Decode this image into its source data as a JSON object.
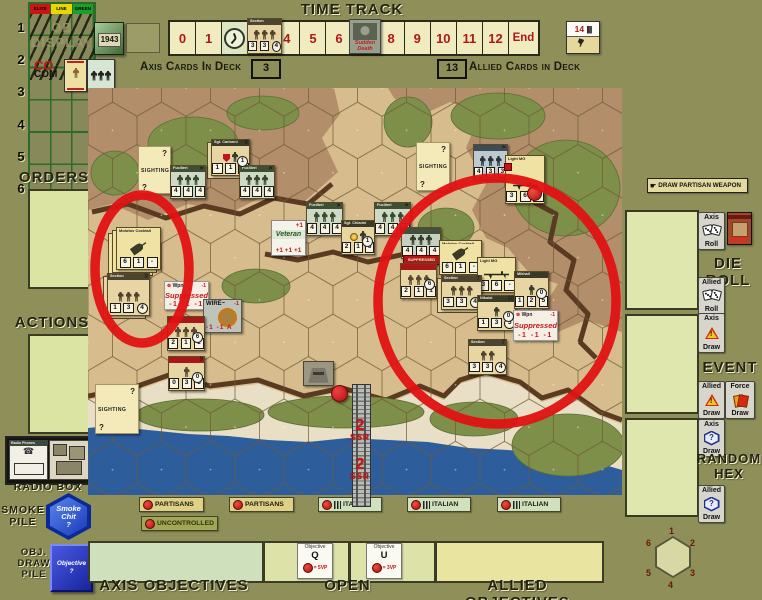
{
  "colors": {
    "accent_red": "#e01212",
    "sea": "#2e5d9c",
    "sand": "#d7bd8d",
    "hill": "#b28e6a",
    "scrub": "#7e8f4a",
    "counter_tan": "#e7d5a4",
    "counter_green": "#cfdac4"
  },
  "ob_display": {
    "headers": [
      "ELITE",
      "LINE",
      "GREEN"
    ],
    "rows": [
      "1",
      "2",
      "3",
      "4",
      "5",
      "6"
    ],
    "ghost1": "OB",
    "ghost2": "DISPLAY",
    "co": "CO",
    "com": "COM"
  },
  "year_card": "1943",
  "time_track": {
    "title": "TIME TRACK",
    "cells": [
      "0",
      "1",
      "2",
      "3",
      "4",
      "5",
      "6",
      "7",
      "8",
      "9",
      "10",
      "11",
      "12",
      "End"
    ],
    "current_cell": "2",
    "hand_card": {
      "number": "14",
      "tallies": "||||"
    }
  },
  "decks": {
    "axis_label": "Axis Cards In Deck",
    "axis_count": "3",
    "allied_count": "13",
    "allied_label": "Allied Cards in Deck"
  },
  "left_panel": {
    "orders": "ORDERS",
    "actions": "ACTIONS",
    "radio_box": "RADIO BOX",
    "radio_card": "Radio Phones",
    "smoke_pile": [
      "SMOKE",
      "PILE"
    ],
    "smoke_chit": [
      "Smoke",
      "Chit",
      "?"
    ],
    "obj_pile": [
      "OBJ.",
      "DRAW",
      "PILE"
    ],
    "obj_chit": [
      "Objective",
      "?"
    ]
  },
  "right_panel": {
    "draw_partisan": "DRAW PARTISAN WEAPON",
    "die_roll": "DIE ROLL",
    "event": "EVENT",
    "random_hex": [
      "RANDOM",
      "HEX"
    ],
    "buttons": {
      "axis_roll": [
        "Axis",
        "Roll"
      ],
      "allied_roll": [
        "Allied",
        "Roll"
      ],
      "axis_event": [
        "Axis",
        "Draw"
      ],
      "allied_event": [
        "Allied",
        "Draw"
      ],
      "force_draw": [
        "Force",
        "Draw"
      ],
      "axis_hex": [
        "Axis",
        "Draw"
      ],
      "allied_hex": [
        "Allied",
        "Draw"
      ]
    },
    "compass": [
      "1",
      "2",
      "3",
      "4",
      "5",
      "6"
    ]
  },
  "bottom": {
    "faction_buttons": [
      {
        "label": "PARTISANS",
        "style": "partisan",
        "x": 139,
        "y": 497,
        "w": 57
      },
      {
        "label": "PARTISANS",
        "style": "partisan",
        "x": 229,
        "y": 497,
        "w": 57
      },
      {
        "label": "ITALIAN",
        "style": "italian",
        "x": 318,
        "y": 497,
        "w": 56
      },
      {
        "label": "ITALIAN",
        "style": "italian",
        "x": 407,
        "y": 497,
        "w": 56
      },
      {
        "label": "ITALIAN",
        "style": "italian",
        "x": 497,
        "y": 497,
        "w": 56
      },
      {
        "label": "UNCONTROLLED",
        "style": "uncontrolled",
        "x": 141,
        "y": 516,
        "w": 60
      }
    ],
    "zones": [
      "AXIS OBJECTIVES",
      "OPEN",
      "ALLIED OBJECTIVES"
    ],
    "objective_cards": [
      {
        "title": "Objective",
        "letter": "Q",
        "vp": "= 5VP",
        "x": 297,
        "y": 543
      },
      {
        "title": "Objective",
        "letter": "U",
        "vp": "= 3VP",
        "x": 366,
        "y": 543
      }
    ]
  },
  "map": {
    "units": [
      {
        "t": "sighting",
        "x": 138,
        "y": 146,
        "w": 31,
        "h": 46,
        "q": "?",
        "label": "SIGHTING"
      },
      {
        "t": "sighting",
        "x": 95,
        "y": 384,
        "w": 42,
        "h": 48,
        "q": "?",
        "label": "SIGHTING"
      },
      {
        "t": "sighting",
        "x": 416,
        "y": 142,
        "w": 32,
        "h": 47,
        "q": "?",
        "label": "SIGHTING"
      },
      {
        "t": "ldr",
        "name": "Sgt. Carlonni",
        "x": 211,
        "y": 139,
        "w": 37,
        "h": 35,
        "vals": [
          "1",
          "1",
          "6"
        ],
        "bg": "#e7d5a4",
        "badge": "1",
        "corner": "8",
        "stack": 2,
        "shield": true
      },
      {
        "t": "sec",
        "name": "Fucilieri",
        "x": 170,
        "y": 165,
        "w": 34,
        "h": 32,
        "vals": [
          "4",
          "4",
          "4"
        ],
        "bg": "#cfdac4",
        "band": "#3f4f36",
        "fig": "#38482e",
        "figs": 3,
        "flag": true
      },
      {
        "t": "sec",
        "name": "Fucilieri",
        "x": 239,
        "y": 165,
        "w": 34,
        "h": 32,
        "vals": [
          "4",
          "4",
          "4"
        ],
        "bg": "#cfdac4",
        "band": "#3f4f36",
        "fig": "#38482e",
        "figs": 3,
        "flag": true
      },
      {
        "t": "vet",
        "x": 271,
        "y": 220,
        "w": 33,
        "h": 34,
        "title": "Veteran",
        "tr": "+1",
        "bot": "+1 +1 +1"
      },
      {
        "t": "sec",
        "name": "Fucilieri",
        "x": 306,
        "y": 202,
        "w": 35,
        "h": 32,
        "vals": [
          "4",
          "4",
          "4"
        ],
        "bg": "#cfdac4",
        "band": "#3f4f36",
        "fig": "#38482e",
        "figs": 3,
        "flag": true
      },
      {
        "t": "ldr",
        "name": "Sgt. Chiarini",
        "x": 341,
        "y": 220,
        "w": 32,
        "h": 33,
        "vals": [
          "2",
          "1",
          "6"
        ],
        "bg": "#e7d5a4",
        "badge": "1",
        "medal": true
      },
      {
        "t": "sec",
        "name": "Fucilieri",
        "x": 374,
        "y": 202,
        "w": 35,
        "h": 32,
        "vals": [
          "4",
          "4",
          "4"
        ],
        "bg": "#cfdac4",
        "band": "#3f4f36",
        "fig": "#38482e",
        "figs": 3,
        "flag": true
      },
      {
        "t": "wpn",
        "name": "Molotov Cocktail",
        "icon": "bottle",
        "x": 116,
        "y": 227,
        "w": 43,
        "h": 41,
        "vals": [
          "6",
          "1",
          "-"
        ],
        "stack": 3,
        "bg": "#efe2a2"
      },
      {
        "t": "sec",
        "name": "Section",
        "x": 107,
        "y": 273,
        "w": 41,
        "h": 41,
        "vals": [
          "1",
          "3",
          "4"
        ],
        "circ": true,
        "bg": "#e7d5a4",
        "band": "#4a4430",
        "fig": "#51402a",
        "figs": 3,
        "corner": "9",
        "stack": 2
      },
      {
        "t": "sup",
        "x": 164,
        "y": 281,
        "w": 43,
        "h": 27,
        "wpn": "Wpn",
        "m1": "-1",
        "word": "Suppressed",
        "m3": "-1 -1 -1"
      },
      {
        "t": "wire",
        "x": 203,
        "y": 299,
        "w": 37,
        "h": 32,
        "label": "WIRE~",
        "tr": "-1",
        "bot": "-1 -1 A"
      },
      {
        "t": "sec",
        "name": "",
        "x": 167,
        "y": 316,
        "w": 36,
        "h": 33,
        "vals": [
          "2",
          "1",
          "1"
        ],
        "bg": "#e7d5a4",
        "band": "#a81818",
        "fig": "#5a4630",
        "figs": 3,
        "badge": "6"
      },
      {
        "t": "sec",
        "name": "",
        "x": 168,
        "y": 356,
        "w": 35,
        "h": 33,
        "vals": [
          "0",
          "3",
          "3"
        ],
        "bg": "#e7d5a4",
        "band": "#a81818",
        "fig": "#5a4630",
        "figs": 1,
        "badge": "0",
        "corner": "9"
      },
      {
        "t": "pill",
        "x": 303,
        "y": 361,
        "w": 29,
        "h": 23
      },
      {
        "t": "sec",
        "name": "",
        "x": 473,
        "y": 144,
        "w": 33,
        "h": 34,
        "vals": [
          "4",
          "3",
          "3"
        ],
        "bg": "#becad0",
        "band": "#3c4c55",
        "fig": "#26323c",
        "figs": 3,
        "flag": true
      },
      {
        "t": "wpn",
        "name": "Light MG",
        "icon": "mg",
        "x": 505,
        "y": 155,
        "w": 38,
        "h": 47,
        "vals": [
          "3",
          "6",
          ""
        ],
        "reddot": true,
        "redtab": true,
        "bg": "#efe2a2"
      },
      {
        "t": "sec",
        "name": "",
        "x": 401,
        "y": 227,
        "w": 38,
        "h": 30,
        "vals": [
          "4",
          "4",
          "4"
        ],
        "bg": "#c6cfc2",
        "band": "#44503e",
        "fig": "#333f2c",
        "figs": 3
      },
      {
        "t": "strip",
        "x": 403,
        "y": 255,
        "w": 35,
        "h": 8,
        "text": "SUPPRESSED"
      },
      {
        "t": "sec",
        "name": "",
        "x": 400,
        "y": 263,
        "w": 35,
        "h": 34,
        "vals": [
          "2",
          "1",
          "1"
        ],
        "bg": "#e7d5a4",
        "band": "#a81818",
        "fig": "#5a4630",
        "figs": 3,
        "badge": "6"
      },
      {
        "t": "wpn",
        "name": "Molotov Cocktail",
        "icon": "bottle",
        "x": 439,
        "y": 240,
        "w": 41,
        "h": 33,
        "vals": [
          "6",
          "1",
          "-"
        ],
        "bg": "#efe2a2"
      },
      {
        "t": "wpn",
        "name": "Light MG",
        "icon": "mg",
        "x": 477,
        "y": 257,
        "w": 37,
        "h": 34,
        "vals": [
          "3",
          "6",
          "-"
        ],
        "bg": "#efe2a2"
      },
      {
        "t": "sec",
        "name": "Section",
        "x": 441,
        "y": 275,
        "w": 39,
        "h": 33,
        "vals": [
          "3",
          "3",
          "4"
        ],
        "circ": true,
        "bg": "#e7d5a4",
        "band": "#4a4430",
        "fig": "#51402a",
        "figs": 3,
        "corner": "7",
        "stack": 2
      },
      {
        "t": "ldr",
        "name": "Nikolai",
        "x": 477,
        "y": 295,
        "w": 37,
        "h": 34,
        "vals": [
          "1",
          "3",
          "5"
        ],
        "circ": true,
        "bg": "#e7d5a4",
        "badge": "0",
        "corner": "10"
      },
      {
        "t": "ldr",
        "name": "Mikhail",
        "x": 514,
        "y": 271,
        "w": 33,
        "h": 36,
        "vals": [
          "1",
          "2",
          "5"
        ],
        "bg": "#e7d5a4",
        "badge": "0"
      },
      {
        "t": "sup",
        "x": 513,
        "y": 310,
        "w": 43,
        "h": 29,
        "wpn": "Wpn",
        "m1": "-1",
        "word": "Suppressed",
        "m3": "-1 -1 -1"
      },
      {
        "t": "sec",
        "name": "Section",
        "x": 468,
        "y": 339,
        "w": 37,
        "h": 34,
        "vals": [
          "3",
          "3",
          "4"
        ],
        "circ": true,
        "bg": "#e7d5a4",
        "band": "#4a4430",
        "fig": "#51402a",
        "figs": 2,
        "corner": "7"
      },
      {
        "t": "disc",
        "x": 331,
        "y": 385,
        "w": 15,
        "h": 15
      },
      {
        "t": "sec",
        "name": "Section",
        "x": 247,
        "y": 18,
        "w": 33,
        "h": 34,
        "vals": [
          "3",
          "3",
          "4"
        ],
        "circ": true,
        "bg": "#e7d5a4",
        "band": "#4a4430",
        "fig": "#51402a",
        "figs": 3
      },
      {
        "t": "sd",
        "x": 349,
        "y": 19,
        "w": 30,
        "h": 33,
        "lines": [
          "Sudden",
          "Death"
        ]
      }
    ],
    "pier": {
      "markers": [
        {
          "big": "2",
          "small": "SSR",
          "x": 342,
          "y": 418
        },
        {
          "big": "2",
          "small": "SSR",
          "x": 342,
          "y": 457
        }
      ]
    },
    "annotations": [
      {
        "cx": 142,
        "cy": 269,
        "rx": 47,
        "ry": 74
      },
      {
        "cx": 497,
        "cy": 301,
        "rx": 119,
        "ry": 123
      }
    ]
  }
}
